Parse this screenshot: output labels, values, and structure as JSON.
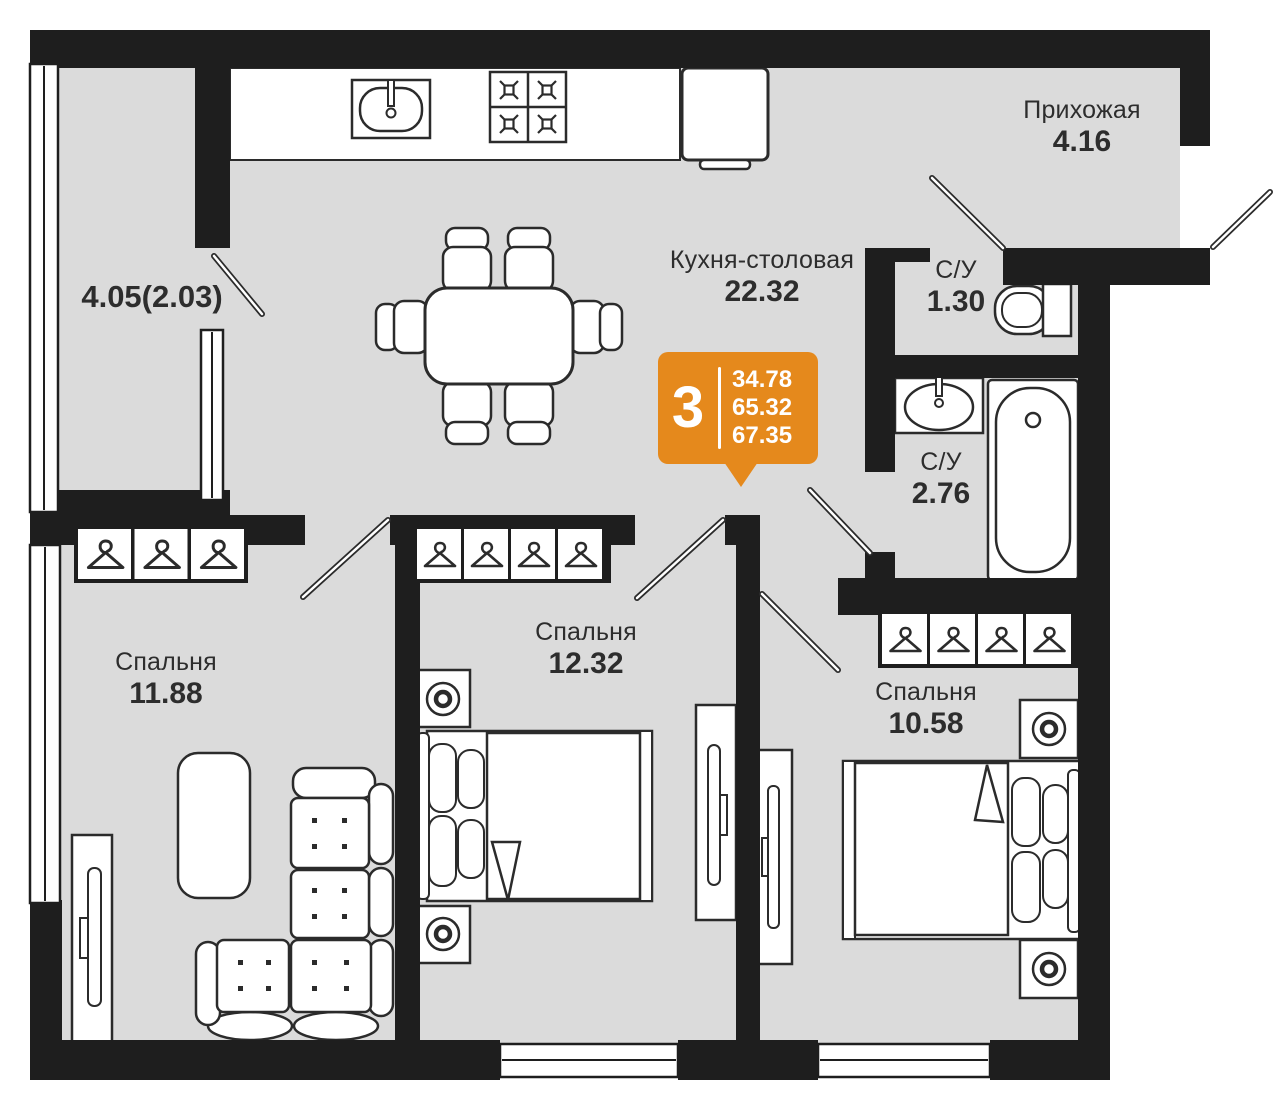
{
  "plan": {
    "type": "apartment-floor-plan",
    "language": "ru",
    "badge": {
      "rooms_count": "3",
      "area_living": "34.78",
      "area_main": "65.32",
      "area_total": "67.35",
      "color": "#E5891C"
    },
    "rooms": [
      {
        "id": "hallway",
        "name": "Прихожая",
        "area": "4.16"
      },
      {
        "id": "kitchen_dining",
        "name": "Кухня-столовая",
        "area": "22.32"
      },
      {
        "id": "bathroom_small",
        "name": "С/У",
        "area": "1.30"
      },
      {
        "id": "bathroom_large",
        "name": "С/У",
        "area": "2.76"
      },
      {
        "id": "bedroom_1",
        "name": "Спальня",
        "area": "11.88"
      },
      {
        "id": "bedroom_2",
        "name": "Спальня",
        "area": "12.32"
      },
      {
        "id": "bedroom_3",
        "name": "Спальня",
        "area": "10.58"
      },
      {
        "id": "balcony",
        "name": "",
        "area": "4.05(2.03)"
      }
    ],
    "colors": {
      "wall": "#1E1E1E",
      "floor": "#DBDBDB",
      "furniture_outline": "#2B2B2B",
      "text": "#2D2D2D",
      "accent": "#E5891C",
      "background": "#FFFFFF"
    }
  }
}
